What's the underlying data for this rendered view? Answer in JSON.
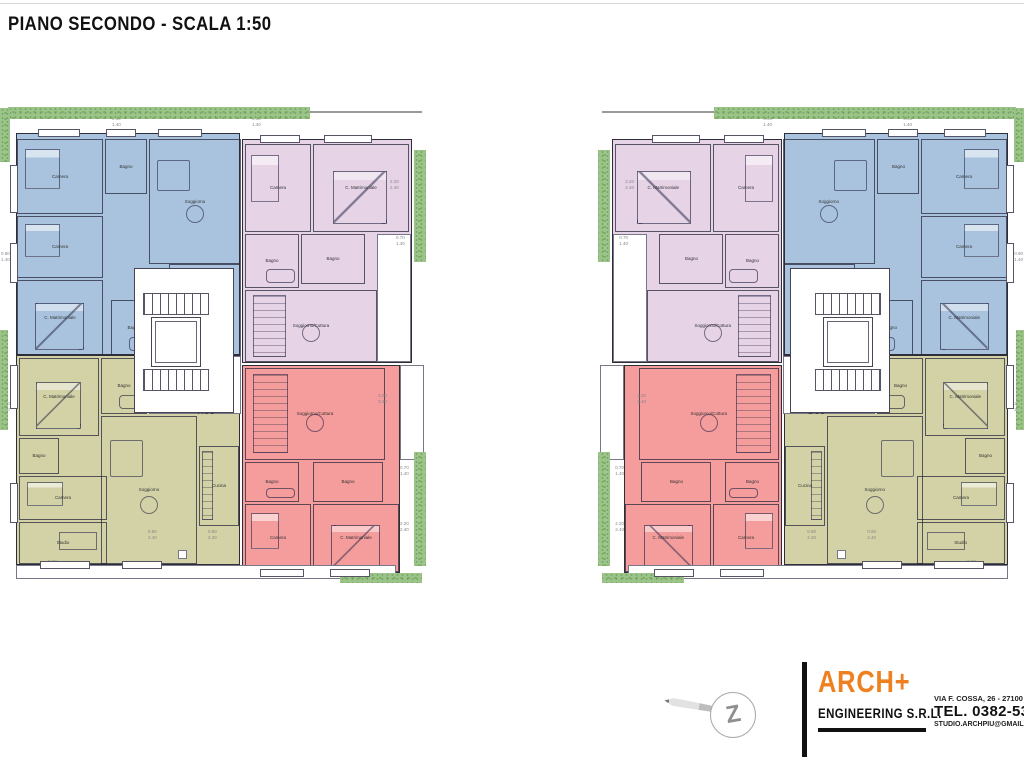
{
  "title": "PIANO SECONDO - SCALA 1:50",
  "palette": {
    "apartment_blue": "#a9c3de",
    "apartment_pink": "#e6d3e6",
    "apartment_olive": "#d2d2a6",
    "apartment_red": "#f59c9c",
    "hedge_green": "#9cc489",
    "wall": "#2e2e38",
    "brand_orange": "#ef8020"
  },
  "dims": {
    "d1": "2.20\n2.40",
    "d2": "0.70\n1.40",
    "d3": "3.20\n3.40",
    "d4": "0.90\n1.40",
    "d5": "0.90\n2.40"
  },
  "buildings": [
    {
      "side": "left",
      "units": [
        {
          "id": "A10",
          "color": "blue",
          "rooms": [
            "Camera",
            "Bagno",
            "Soggiorno",
            "Cucina",
            "Camera",
            "C. Matrimoniale",
            "Bagno"
          ]
        },
        {
          "id": "A11",
          "color": "pink",
          "rooms": [
            "Camera",
            "C. Matrimoniale",
            "Bagno",
            "Bagno",
            "Soggiorno/Cottura"
          ]
        },
        {
          "id": "A12",
          "color": "red",
          "rooms": [
            "Soggiorno/Cottura",
            "Bagno",
            "Bagno",
            "Camera",
            "C. Matrimoniale"
          ]
        },
        {
          "id": "A09",
          "color": "olive",
          "rooms": [
            "C. Matrimoniale",
            "Bagno",
            "Bagno",
            "Camera",
            "Studio",
            "Soggiorno",
            "Cucina"
          ]
        }
      ]
    },
    {
      "side": "right",
      "units": [
        {
          "id": "B10",
          "color": "blue",
          "rooms": [
            "Camera",
            "Bagno",
            "Soggiorno",
            "Cucina",
            "Camera",
            "C. Matrimoniale",
            "Bagno"
          ]
        },
        {
          "id": "B11",
          "color": "pink",
          "rooms": [
            "Camera",
            "C. Matrimoniale",
            "Bagno",
            "Bagno",
            "Soggiorno/Cottura"
          ]
        },
        {
          "id": "B12",
          "color": "red",
          "rooms": [
            "Soggiorno/Cottura",
            "Bagno",
            "Bagno",
            "Camera",
            "C. Matrimoniale"
          ]
        },
        {
          "id": "B09",
          "color": "olive",
          "rooms": [
            "C. Matrimoniale",
            "Bagno",
            "Bagno",
            "Camera",
            "Studio",
            "Soggiorno",
            "Cucina"
          ]
        }
      ]
    }
  ],
  "footer": {
    "brand": "ARCH+",
    "brand_sub": "ENGINEERING S.R.L.",
    "address": "VIA F. COSSA, 26 - 27100 P",
    "phone": "TEL. 0382-5304",
    "email": "STUDIO.ARCHPIU@GMAIL."
  }
}
